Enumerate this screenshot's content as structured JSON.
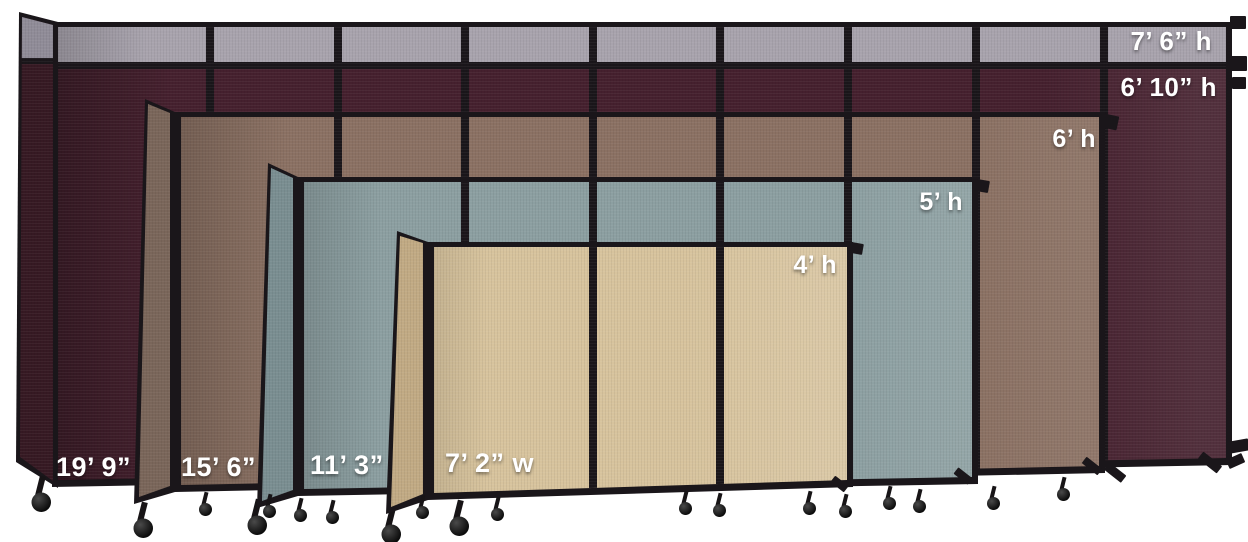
{
  "colors": {
    "background": "#ffffff",
    "frame": "#1a161a",
    "gray_top": "#a8a3ad",
    "gray_top_dark": "#908c98",
    "cranberry": "#45202e",
    "cranberry_dark": "#361923",
    "mocha": "#8b7163",
    "mocha_dark": "#7a665a",
    "ocean": "#8c9fa1",
    "ocean_dark": "#7a8e91",
    "sand": "#d7c39d",
    "sand_dark": "#c1aa84",
    "label": "#ffffff"
  },
  "walls": [
    {
      "id": "wall-cranberry",
      "fabric": "cranberry",
      "fabric_color": "#45202e",
      "top_row_fabric_color": "#a8a3ad",
      "visible_panels": 9,
      "labels": {
        "height_top": "7’ 6” h",
        "height": "6’ 10” h",
        "width": "19’ 9” w"
      }
    },
    {
      "id": "wall-mocha",
      "fabric": "mocha",
      "fabric_color": "#8b7163",
      "visible_panels": 7,
      "labels": {
        "height": "6’ h",
        "width": "15’ 6” w"
      }
    },
    {
      "id": "wall-ocean",
      "fabric": "ocean",
      "fabric_color": "#8c9fa1",
      "visible_panels": 5,
      "labels": {
        "height": "5’ h",
        "width": "11’ 3” w"
      }
    },
    {
      "id": "wall-sand",
      "fabric": "sand",
      "fabric_color": "#d7c39d",
      "visible_panels": 3,
      "labels": {
        "height": "4’ h",
        "width": "7’ 2” w"
      }
    }
  ],
  "icons": {
    "caster-wheel-icon": "css-circle-wheel",
    "wall-bracket-icon": "css-rect-tab",
    "floor-foot-icon": "css-angled-rect"
  }
}
